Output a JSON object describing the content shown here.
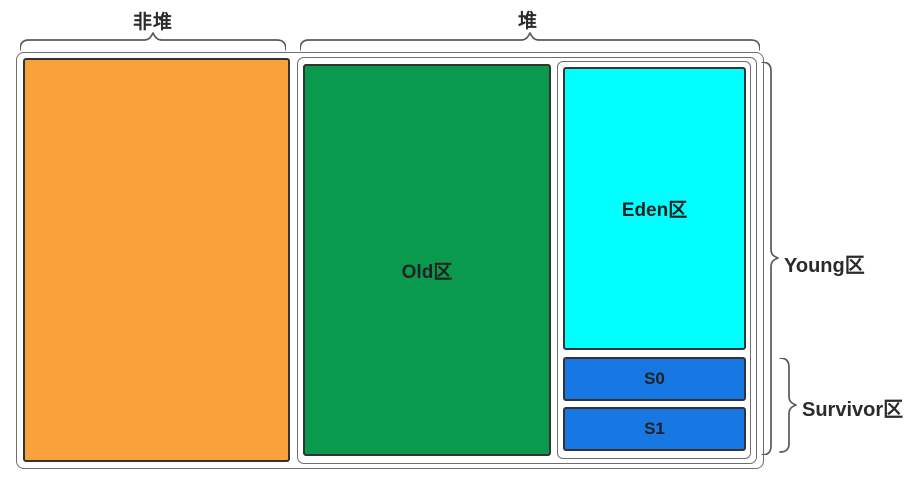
{
  "diagram": {
    "top": {
      "nonheap_label": "非堆",
      "heap_label": "堆"
    },
    "regions": {
      "old_label": "Old区",
      "eden_label": "Eden区",
      "s0_label": "S0",
      "s1_label": "S1"
    },
    "side": {
      "young_label": "Young区",
      "survivor_label": "Survivor区"
    },
    "colors": {
      "background": "#FFFFFF",
      "nonheap_fill": "#F9A23C",
      "old_fill": "#0A9A4D",
      "eden_fill": "#00FFFF",
      "survivor_fill": "#1777E3",
      "box_border": "#333333",
      "container_border": "#6E6E6E",
      "brace_stroke": "#595959",
      "text": "#2B2B2B"
    }
  }
}
